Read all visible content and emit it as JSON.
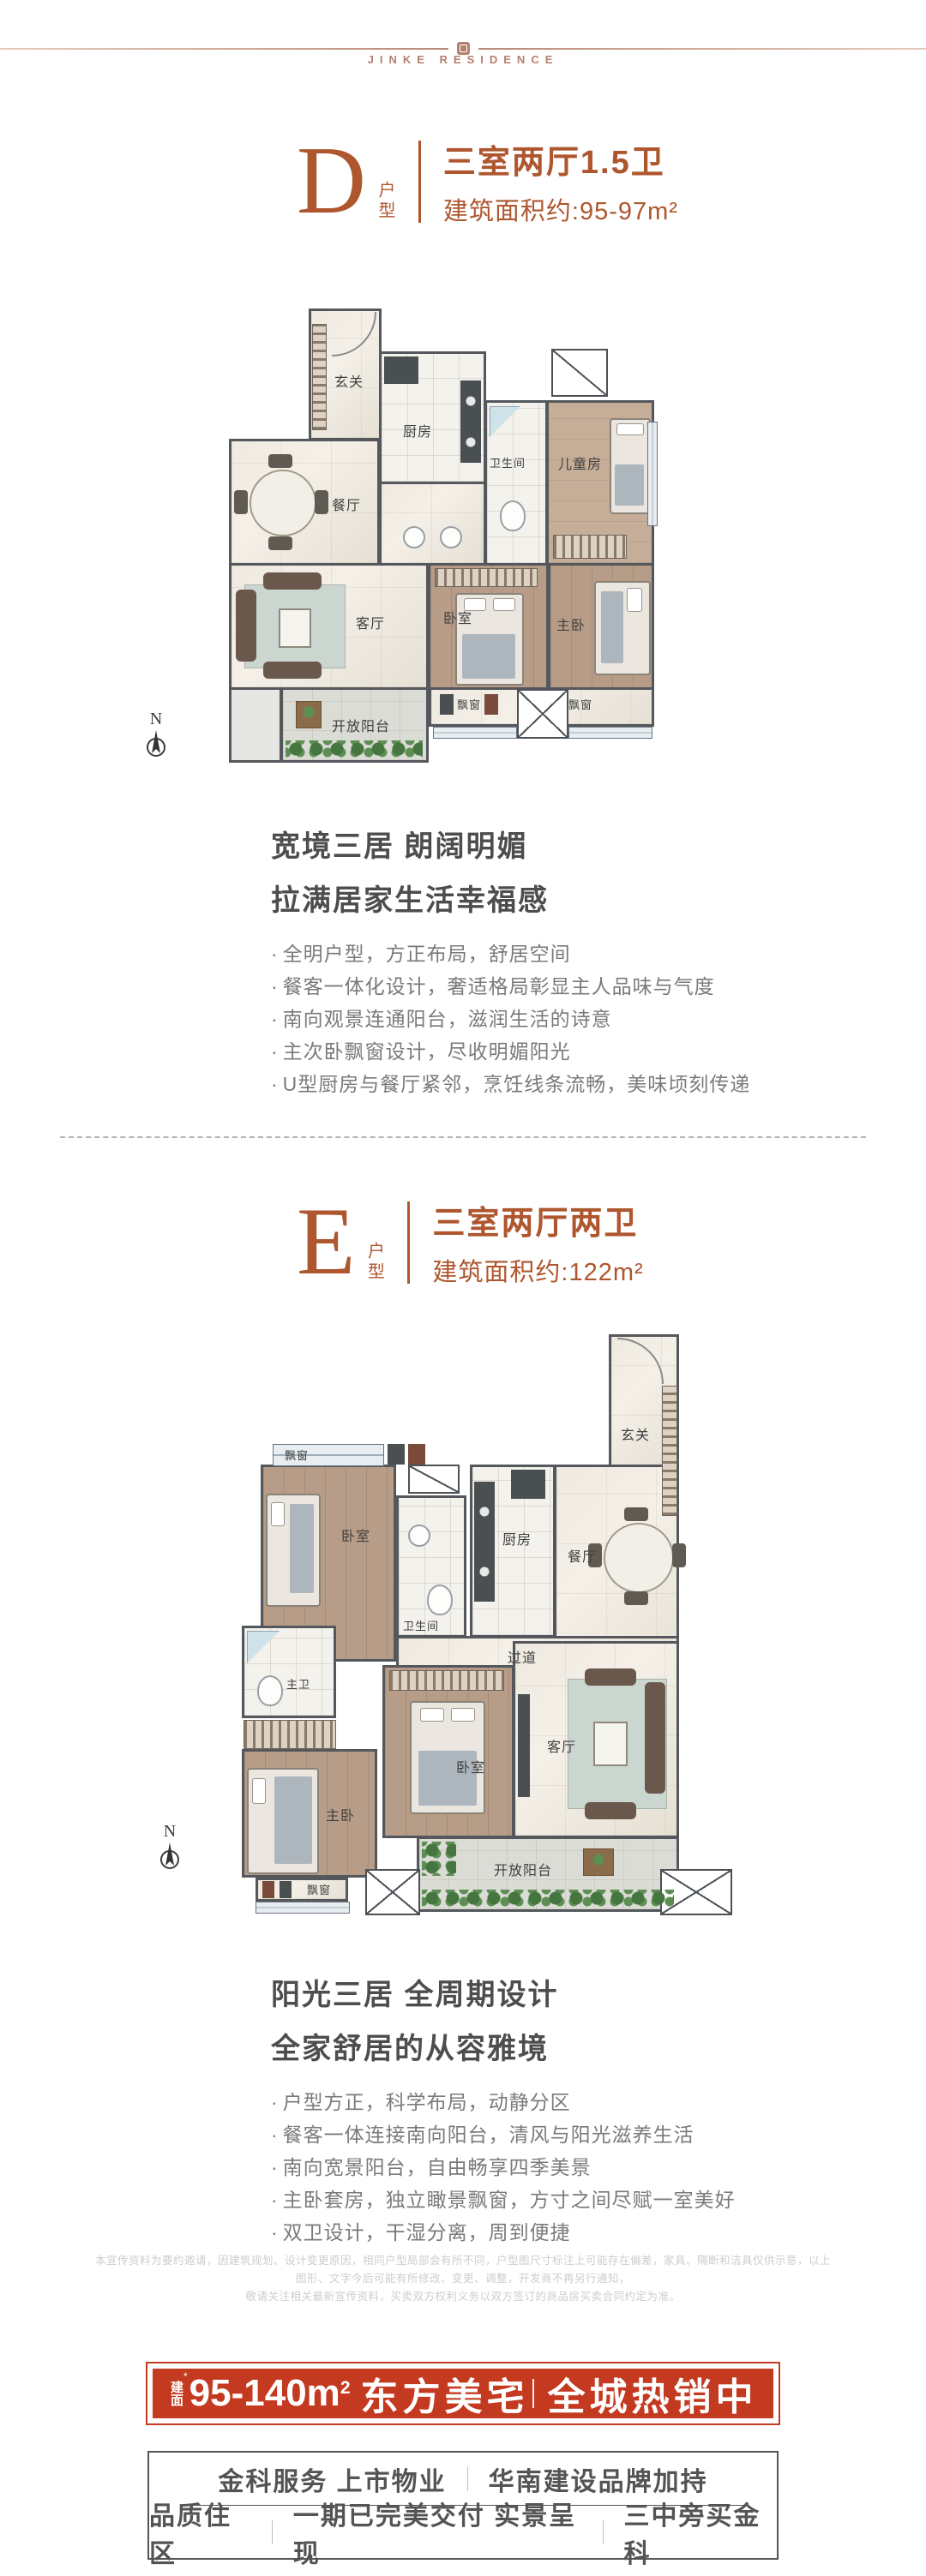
{
  "header": {
    "brand": "JINKE RESIDENCE"
  },
  "unit_d": {
    "letter": "D",
    "letter_suffix": "户型",
    "title": "三室两厅1.5卫",
    "area": "建筑面积约:95-97m²",
    "heading_line1": "宽境三居 朗阔明媚",
    "heading_line2": "拉满居家生活幸福感",
    "bullets": [
      "全明户型，方正布局，舒居空间",
      "餐客一体化设计，奢适格局彰显主人品味与气度",
      "南向观景连通阳台，滋润生活的诗意",
      "主次卧飘窗设计，尽收明媚阳光",
      "U型厨房与餐厅紧邻，烹饪线条流畅，美味顷刻传递"
    ],
    "plan": {
      "compass": "N",
      "rooms": {
        "entry": "玄关",
        "kitchen": "厨房",
        "bath": "卫生间",
        "kids": "儿童房",
        "dining": "餐厅",
        "living": "客厅",
        "bedroom": "卧室",
        "master": "主卧",
        "balcony": "开放阳台",
        "bay1": "飘窗",
        "bay2": "飘窗"
      }
    }
  },
  "unit_e": {
    "letter": "E",
    "letter_suffix": "户型",
    "title": "三室两厅两卫",
    "area": "建筑面积约:122m²",
    "heading_line1": "阳光三居 全周期设计",
    "heading_line2": "全家舒居的从容雅境",
    "bullets": [
      "户型方正，科学布局，动静分区",
      "餐客一体连接南向阳台，清风与阳光滋养生活",
      "南向宽景阳台，自由畅享四季美景",
      "主卧套房，独立瞰景飘窗，方寸之间尽赋一室美好",
      "双卫设计，干湿分离，周到便捷"
    ],
    "plan": {
      "compass": "N",
      "rooms": {
        "entry": "玄关",
        "bay_top": "飘窗",
        "bedroom2": "卧室",
        "bath": "卫生间",
        "kitchen": "厨房",
        "dining": "餐厅",
        "corridor": "过道",
        "master_bath": "主卫",
        "master": "主卧",
        "bedroom": "卧室",
        "living": "客厅",
        "balcony": "开放阳台",
        "bay_bottom": "飘窗"
      }
    }
  },
  "disclaimer": {
    "line1": "本宣传资料为要约邀请，因建筑规划、设计变更原因，相同户型局部会有所不同，户型图尺寸标注上可能存在偏差，家具、隔断和洁具仅供示意，以上图形、文字今后可能有所修改、变更、调整，开发商不再另行通知，",
    "line2": "敬请关注相关最新宣传资料，买卖双方权利义务以双方签订的商品房买卖合同约定为准。"
  },
  "banner": {
    "label_stacked": "建面",
    "mark": "*",
    "range": "95-140m",
    "sup": "2",
    "name": "东方美宅",
    "status": "全城热销中"
  },
  "footer": {
    "row1": [
      "金科服务 上市物业",
      "华南建设品牌加持"
    ],
    "row2": [
      "品质住区",
      "一期已完美交付 实景呈现",
      "三中旁买金科"
    ]
  },
  "colors": {
    "accent": "#ae562e",
    "banner_red": "#c43a20",
    "heading_gray": "#4d4d4d",
    "bullet_gray": "#7a7a7a",
    "wall": "#54585c"
  }
}
